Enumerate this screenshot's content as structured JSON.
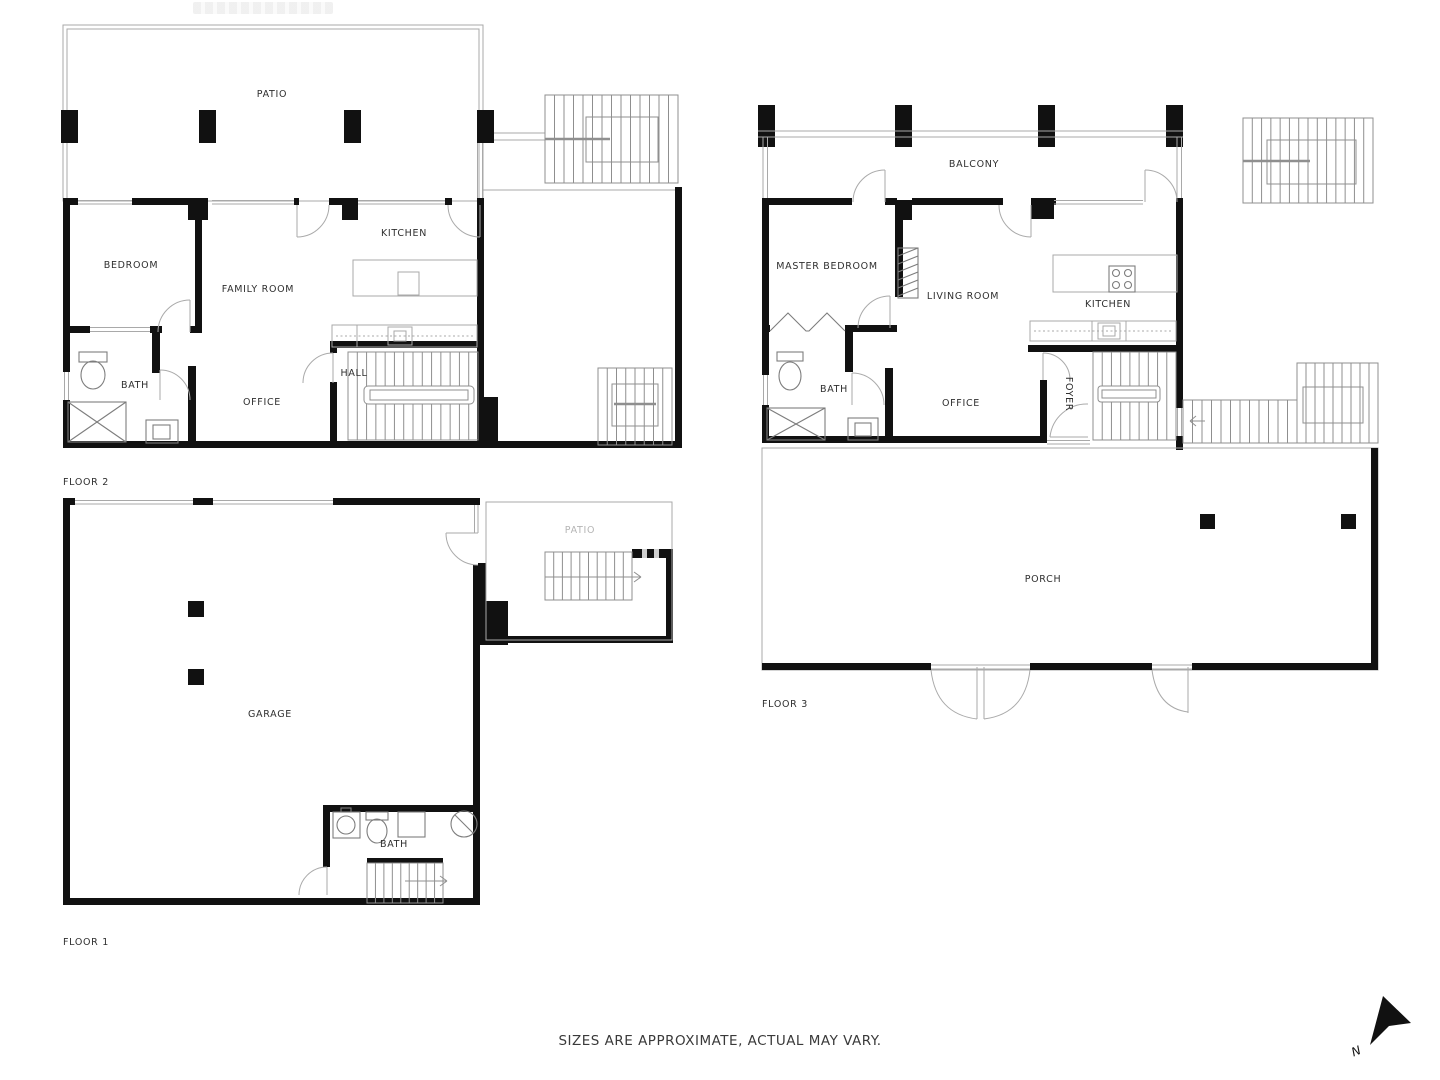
{
  "disclaimer": "SIZES ARE APPROXIMATE, ACTUAL MAY VARY.",
  "compass": {
    "north": "N"
  },
  "colors": {
    "wall": "#111111",
    "thin_line": "#a9a9a9",
    "stair_line": "#8f8f8f",
    "fixture_line": "#7d7d7d",
    "door_line": "#aaaaaa",
    "label_text": "#2f2f2f",
    "patio_label": "#b5b5b5"
  },
  "floor2": {
    "label": "FLOOR 2",
    "rooms": {
      "patio": "PATIO",
      "bedroom": "BEDROOM",
      "family_room": "FAMILY ROOM",
      "kitchen": "KITCHEN",
      "bath": "BATH",
      "office": "OFFICE",
      "hall": "HALL"
    }
  },
  "floor3": {
    "label": "FLOOR 3",
    "rooms": {
      "balcony": "BALCONY",
      "master_bedroom": "MASTER BEDROOM",
      "living_room": "LIVING ROOM",
      "kitchen": "KITCHEN",
      "bath": "BATH",
      "office": "OFFICE",
      "foyer": "FOYER",
      "porch": "PORCH"
    }
  },
  "floor1": {
    "label": "FLOOR 1",
    "rooms": {
      "patio": "PATIO",
      "garage": "GARAGE",
      "bath": "BATH"
    }
  }
}
